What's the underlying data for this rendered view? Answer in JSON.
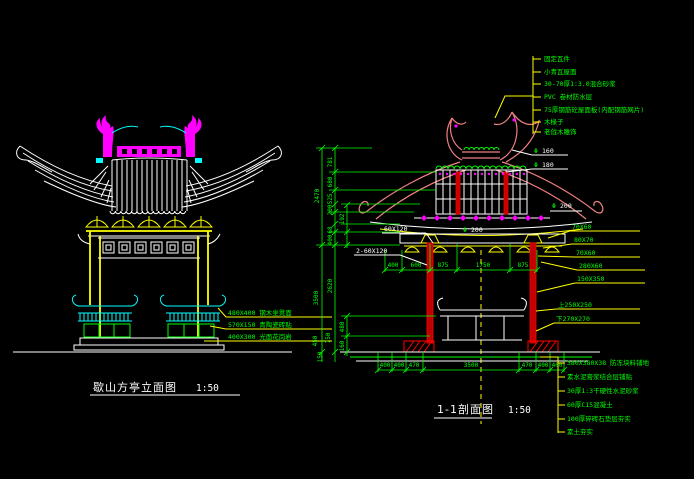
{
  "app": {
    "background": "#000000"
  },
  "colors": {
    "line": "#ffffff",
    "annotation": "#00ff00",
    "leader": "#ffff00",
    "ridge": "#ff00ff",
    "bench": "#00ffff",
    "column": "#ff0000",
    "eave": "#f08080"
  },
  "left": {
    "title": "歇山方亭立面图",
    "scale": "1:50",
    "callouts": [
      "480X400 钢木坐凳面",
      "570X150 青陶瓷砖贴",
      "400X300 光面花岗岩"
    ]
  },
  "right": {
    "title": "1-1剖面图",
    "scale": "1:50",
    "roof_layers": [
      "固定瓦件",
      "小青瓦屋面",
      "30-70厚1:3.0混合砂浆",
      "PVC 卷材防水层",
      "75厚钢筋砼屋面板(内配钢筋网片)",
      "木椽子",
      "老戗木雕饰"
    ],
    "floor_layers": [
      "380X380X38 防冻块料铺地",
      "素水泥膏浆结合层铺贴",
      "30厚1:3干硬性水泥砂浆",
      "60厚C15混凝土",
      "100厚碎砖石垫层夯实",
      "素土夯实"
    ],
    "member_labels": [
      "70X60",
      "80X70",
      "70X60",
      "280X60",
      "150X350",
      "上250X250",
      "下270X270"
    ],
    "beam_labels": [
      "60X120",
      "2-60X120"
    ],
    "phi": "Φ",
    "dia_values": [
      "160",
      "180",
      "200",
      "200"
    ],
    "vdims_upper": [
      "2470",
      "781",
      "680",
      "525",
      "200",
      "192",
      "68",
      "400"
    ],
    "vdims_lower": [
      "3500",
      "2620",
      "450",
      "750",
      "480",
      "160",
      "150"
    ],
    "hdims_inner": [
      "400",
      "600",
      "875",
      "1750",
      "875"
    ],
    "hdims_bottom": [
      "400",
      "400",
      "470",
      "3500",
      "470",
      "400",
      "400"
    ]
  }
}
